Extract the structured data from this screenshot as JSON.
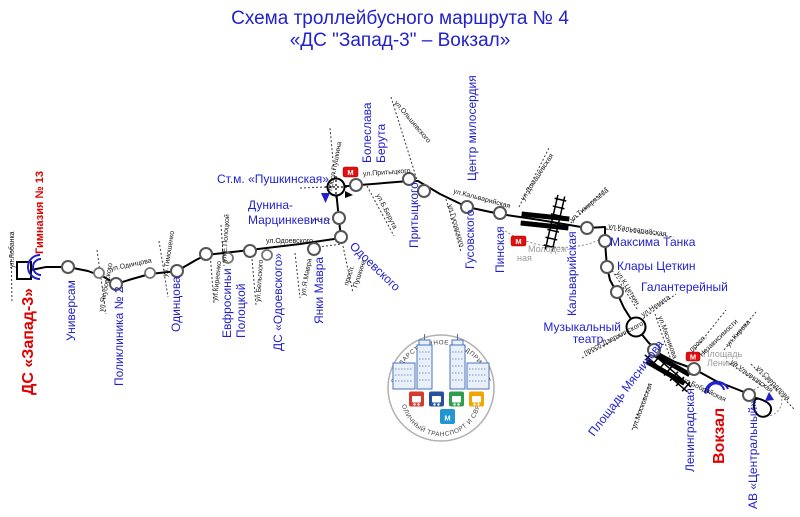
{
  "title": {
    "line1": "Схема троллейбусного маршрута № 4",
    "line2": "«ДС \"Запад-3\" – Вокзал»"
  },
  "terminals": {
    "west": "ДС «Запад-3»",
    "gymnasium": "Гимназия № 13",
    "east": "Вокзал"
  },
  "stops": {
    "universam": "Универсам",
    "poliklinika": "Поликлиника № 2",
    "odintsova": "Одинцова",
    "evfrosini_1": "Евфросиньи",
    "evfrosini_2": "Полоцкой",
    "ds_odoevskogo": "ДС «Одоевского»",
    "yanki_mavra": "Янки Мавра",
    "odoevskogo": "Одоевского",
    "dunina_1": "Дунина-",
    "dunina_2": "Марцинкевича",
    "pushkinskaya": "Ст.м. «Пушкинская»",
    "beruta_1": "Болеслава",
    "beruta_2": "Берута",
    "pritytskogo": "Притыцкого",
    "centr_miloserdiya": "Центр милосердия",
    "gusovskogo": "Гусовского",
    "pinskaya": "Пинская",
    "kalvariyskaya": "Кальварийская",
    "maksima_tanka": "Максима Танка",
    "klary_tsetkin": "Клары Цеткин",
    "galantereyny": "Галантерейный",
    "muzteatr_1": "Музыкальный",
    "muzteatr_2": "театр",
    "pl_myasnikova": "Площадь Мясникова",
    "leningradskaya": "Ленинградская",
    "av_centralny": "АВ «Центральный»"
  },
  "streets": {
    "lobanka": "ул.Лобанка",
    "yakubovskogo": "ул.Якубовского",
    "odintsova": "ул.Одинцова",
    "timoshenko": "ул.Тимошенко",
    "kireenko": "ул.Киреенко",
    "e_polotskoy": "ул.Е.Полоцкой",
    "belskogo": "ул.Бельского",
    "ya_mavra": "ул.Я.Мавра",
    "odoevskogo": "ул.Одоевского",
    "prosp_pushkina": "просп.Пушкина",
    "prosp_2a": "просп.",
    "prosp_2b": "Пушкина",
    "pritytskogo": "ул.Притыцкого",
    "olshevskogo": "ул.Ольшевского",
    "b_beruta": "ул.Б.Берута",
    "kalvariyskaya1": "ул.Кальварийская",
    "gusovskogo": "ул.Гусовского",
    "domashevskaya": "ул.Домашевская",
    "timiryazeva": "ул.Тимирязева",
    "kalvariyskaya2": "ул.Кальварийская",
    "k_tsetkin": "ул.К.Цеткин",
    "nemiga": "ул.Немига",
    "dzerzhinskogo": "просп.Дзержинского",
    "myasnikova": "ул.Мясникова",
    "nezavisimosti_1": "просп.",
    "nezavisimosti_2": "Независимости",
    "kirova": "ул.Кирова",
    "ulyanovskaya": "ул.Ульяновская",
    "sverdlova": "ул.Свердлова",
    "bobruyskaya": "ул.Бобруйская",
    "moskovskaya": "ул.Московская"
  },
  "metro": {
    "m": "М",
    "molodezhnaya_1": "Молодеж-",
    "molodezhnaya_2": "ная",
    "lenina_1": "Площадь",
    "lenina_2": "Ленина"
  },
  "logo": {
    "top": "ГОСУДАРСТВЕННОЕ ПРЕДПРИЯТИЕ",
    "bottom": "СТОЛИЧНЫЙ ТРАНСПОРТ И СВЯЗЬ"
  },
  "colors": {
    "stop_label": "#1f1fcc",
    "terminal_label": "#e00000",
    "metro_icon": "#e01010",
    "route_line": "#000000",
    "logo_squares": [
      "#d7392f",
      "#27509e",
      "#2f9e4c",
      "#f0a500",
      "#2196d0"
    ]
  }
}
